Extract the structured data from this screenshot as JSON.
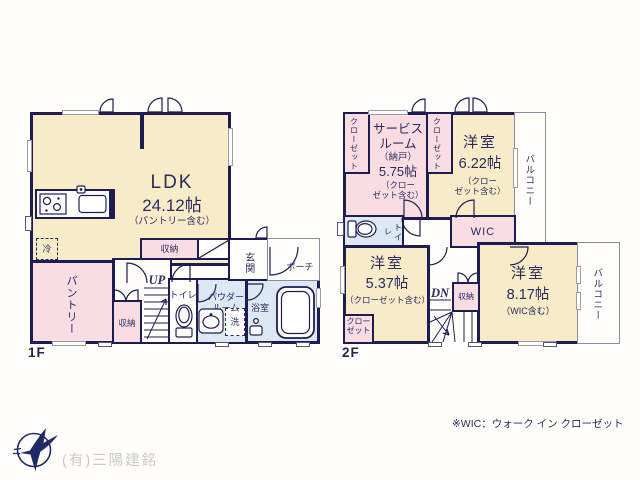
{
  "colors": {
    "wall_navy": "#1d1d52",
    "text_navy": "#2b2b5e",
    "room_cream": "#f8ebc7",
    "room_pink": "#fadce3",
    "room_blue": "#dce9f4",
    "window_gray": "#9a9aae",
    "company_gray": "#c9c9c9",
    "logo_navy": "#1f2a66"
  },
  "floor1": {
    "label": "1F",
    "ldk_name": "LDK",
    "ldk_size": "24.12帖",
    "ldk_note": "（パントリー含む）",
    "pantry": "パントリー",
    "storage_strip": "収納",
    "storage_small": "収納",
    "up": "UP",
    "toilet": "トイレ",
    "powder_line1": "パウダー",
    "powder_line2": "ルーム",
    "laundry": "洗",
    "bath": "浴室",
    "entrance": "玄関",
    "porch": "ポーチ",
    "fridge": "冷"
  },
  "floor2": {
    "label": "2F",
    "service_line1": "サービス",
    "service_line2": "ルーム",
    "service_line3": "（納戸）",
    "service_size": "5.75帖",
    "service_note1": "（クロー",
    "service_note2": "ゼット含む）",
    "closet_v1": "クローゼット",
    "closet_v2": "クローゼット",
    "closet_sw_line1": "クロー",
    "closet_sw_line2": "ゼット",
    "room622_name": "洋室",
    "room622_size": "6.22帖",
    "room622_note1": "（クロー",
    "room622_note2": "ゼット含む）",
    "balcony_top": "バルコニー",
    "balcony_bottom": "バルコニー",
    "toilet": "トイレ",
    "wic": "WIC",
    "room537_name": "洋室",
    "room537_size": "5.37帖",
    "room537_note": "（クローゼット含む）",
    "dn": "DN",
    "storage": "収納",
    "room817_name": "洋室",
    "room817_size": "8.17帖",
    "room817_note": "（WIC含む）"
  },
  "footer": {
    "wic_note": "※WIC：ウォーク イン クローゼット",
    "company": "(有)三陽建銘"
  }
}
